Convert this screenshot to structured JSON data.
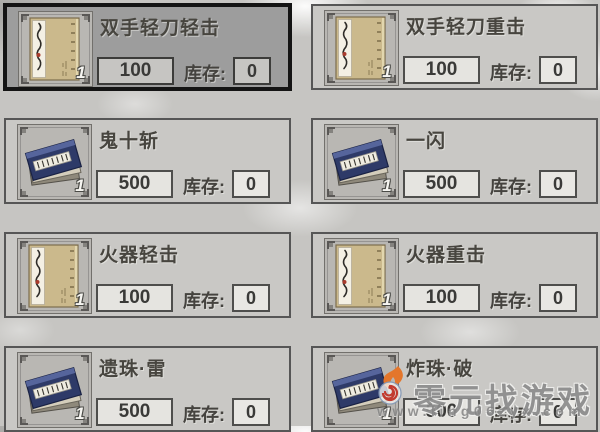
{
  "labels": {
    "stock": "库存:"
  },
  "cards": [
    {
      "title": "双手轻刀轻击",
      "price": "100",
      "stock": "0",
      "count": "1",
      "icon": "scroll-book-icon",
      "selected": true
    },
    {
      "title": "双手轻刀重击",
      "price": "100",
      "stock": "0",
      "count": "1",
      "icon": "scroll-book-icon",
      "selected": false
    },
    {
      "title": "鬼十斩",
      "price": "500",
      "stock": "0",
      "count": "1",
      "icon": "book-stack-icon",
      "selected": false
    },
    {
      "title": "一闪",
      "price": "500",
      "stock": "0",
      "count": "1",
      "icon": "book-stack-icon",
      "selected": false
    },
    {
      "title": "火器轻击",
      "price": "100",
      "stock": "0",
      "count": "1",
      "icon": "scroll-book-icon",
      "selected": false
    },
    {
      "title": "火器重击",
      "price": "100",
      "stock": "0",
      "count": "1",
      "icon": "scroll-book-icon",
      "selected": false
    },
    {
      "title": "遗珠·雷",
      "price": "500",
      "stock": "0",
      "count": "1",
      "icon": "book-stack-icon",
      "selected": false
    },
    {
      "title": "炸珠·破",
      "price": "500",
      "stock": "0",
      "count": "1",
      "icon": "book-stack-icon",
      "selected": false
    }
  ],
  "watermark": {
    "site_name": "零元找游戏",
    "url": "www.ling06zyx.com"
  },
  "colors": {
    "page_bg": "#c6c5c2",
    "card_bg": "#c9c8c5",
    "card_border": "#565656",
    "selected_card_bg": "#9d9d9d",
    "selected_card_border": "#141414",
    "value_box_bg": "#e5e4e0",
    "text": "#45433f",
    "watermark_gray": "#8d8d8d",
    "watermark_orange": "#e4762b",
    "watermark_red": "#c23a2e",
    "book_navy": "#2e3a68",
    "scroll_tan": "#cbb98c"
  }
}
